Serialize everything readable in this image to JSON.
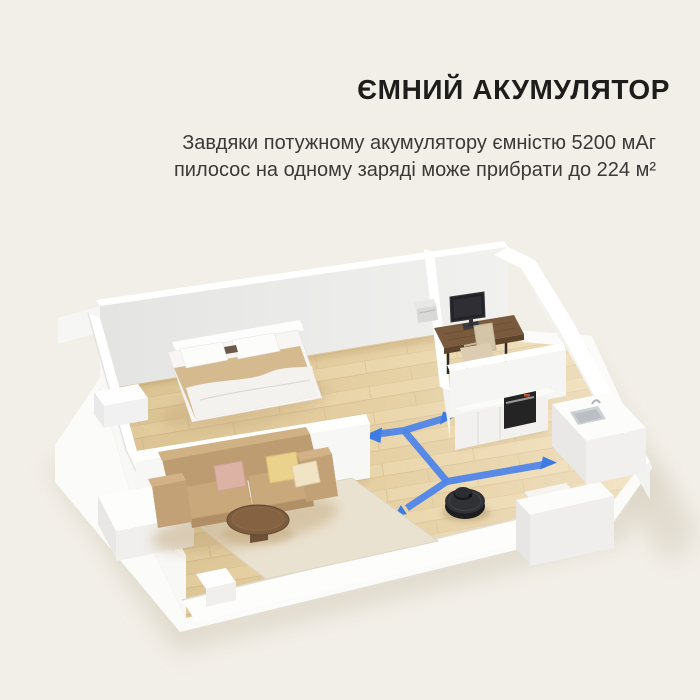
{
  "heading": {
    "title": "ЄМНИЙ АКУМУЛЯТОР",
    "subtitle_line1": "Завдяки потужному акумулятору ємністю 5200 мАг",
    "subtitle_line2": "пилосос на одному заряді може прибрати до 224 м²"
  },
  "product_claims": {
    "battery_capacity": "5200 мАг",
    "coverage_per_charge": "224 м²"
  },
  "colors": {
    "background": "#F2EFE8",
    "path-blue": "#4F85E8",
    "arrow-blue": "#3E7CE4",
    "floor-wood": "#E8D2A4",
    "wall-white": "#FFFFFF",
    "robot-body": "#303236",
    "sofa-tan": "#C9A87B",
    "title-color": "#1E1D1B",
    "subtitle-color": "#3A3938"
  }
}
